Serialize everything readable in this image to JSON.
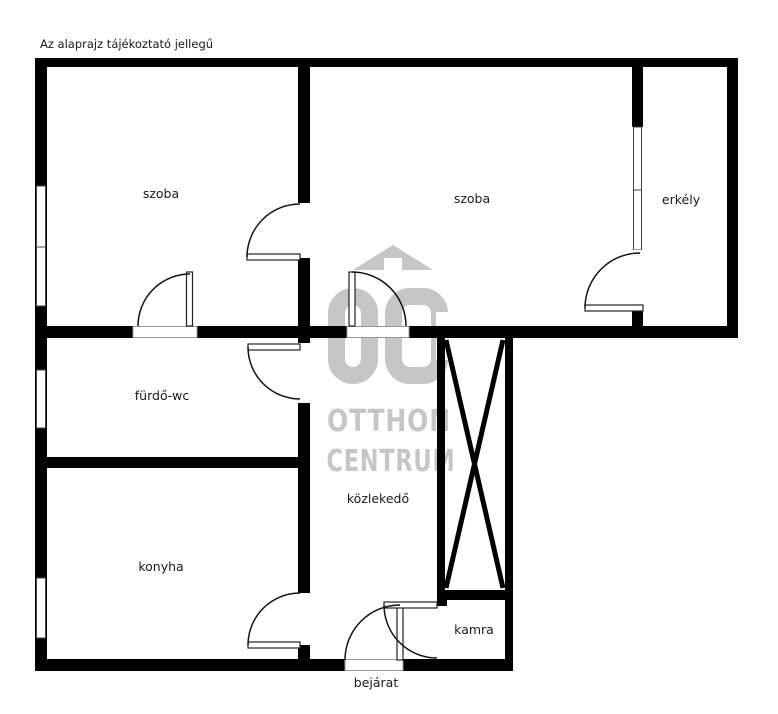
{
  "disclaimer": "Az alaprajz tájékoztató jellegű",
  "rooms": {
    "szoba_left": {
      "label": "szoba"
    },
    "szoba_right": {
      "label": "szoba"
    },
    "erkely": {
      "label": "erkély"
    },
    "furdo_wc": {
      "label": "fürdő-wc"
    },
    "konyha": {
      "label": "konyha"
    },
    "kozlekedo": {
      "label": "közlekedő"
    },
    "kamra": {
      "label": "kamra"
    },
    "bejarat": {
      "label": "bejárat"
    }
  },
  "watermark": {
    "monogram": "OC",
    "line1": "OTTHON",
    "line2": "CENTRUM",
    "color": "#c6c6c6"
  },
  "colors": {
    "wall": "#000000",
    "background": "#ffffff",
    "label_text": "#1a1a1a",
    "door_line": "#111111",
    "leaf_border": "#222222",
    "threshold_border": "#999999",
    "window_border": "#444444"
  }
}
